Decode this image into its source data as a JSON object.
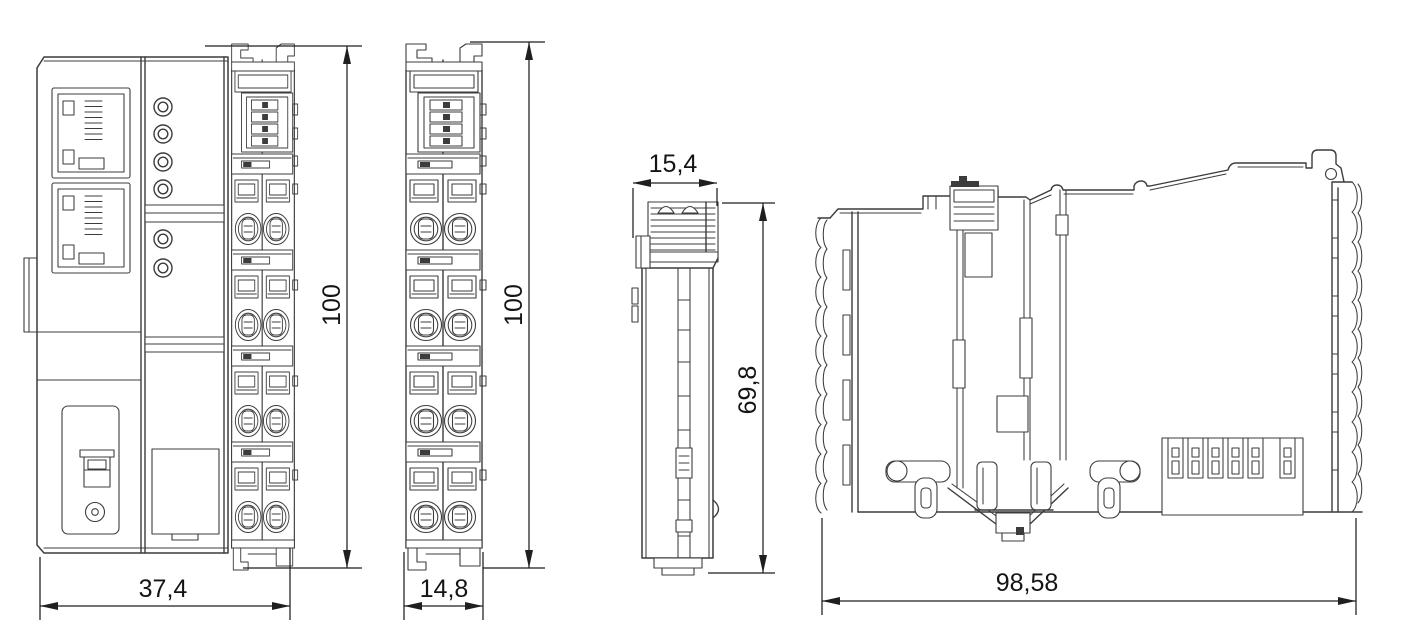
{
  "drawing": {
    "type": "technical-dimension-drawing",
    "views": {
      "coupler_front": {
        "width": "37,4",
        "height": "100"
      },
      "terminal_front": {
        "width": "14,8",
        "height": "100"
      },
      "terminal_side_narrow": {
        "width": "15,4",
        "height": "69,8"
      },
      "terminal_side_profile": {
        "width": "98,58"
      }
    },
    "colors": {
      "background": "#ffffff",
      "line": "#3c3c3c",
      "dimension_line": "#1f1f1f",
      "text": "#141414"
    }
  }
}
